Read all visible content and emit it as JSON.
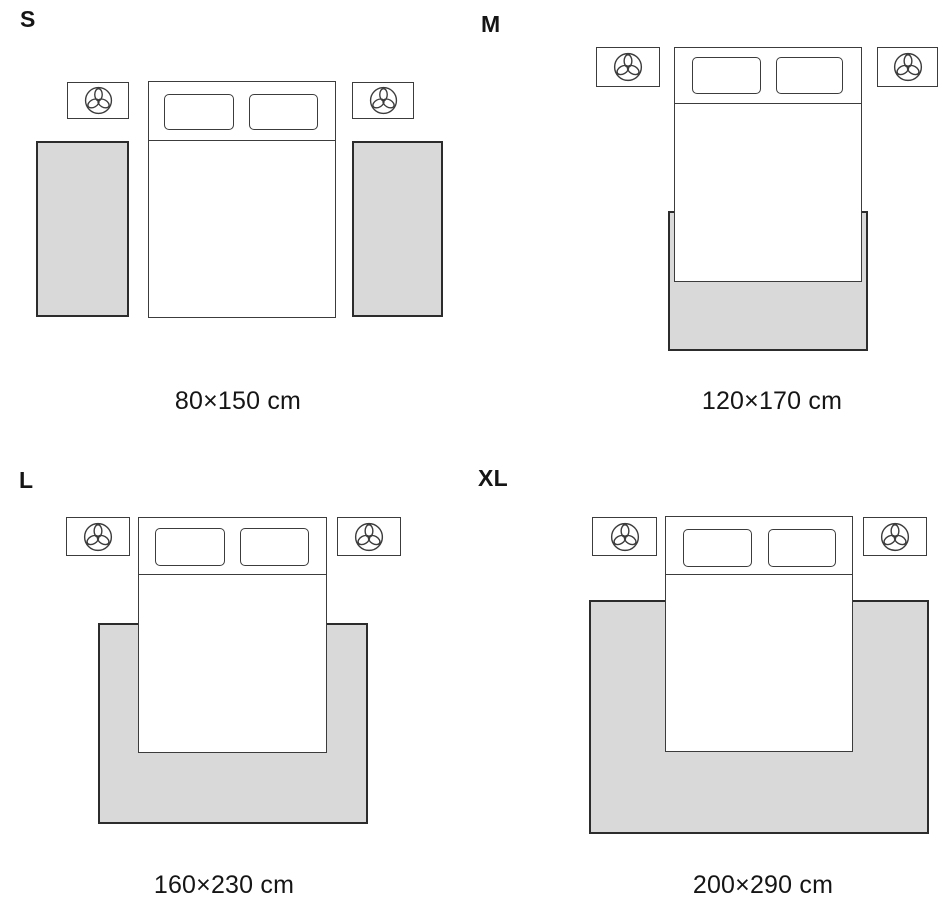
{
  "title": "Rug size guide for bedroom",
  "colors": {
    "background": "#ffffff",
    "outline": "#3c3c3c",
    "rug_fill": "#d9d9d9",
    "rug_border": "#2c2c2c",
    "text": "#151515"
  },
  "icon_names": {
    "nightstand_icon": "plant-icon"
  },
  "panels": [
    {
      "label": "S",
      "size_label": "80×150 cm",
      "rug_placement": "two runner rugs, one on each side of the bed"
    },
    {
      "label": "M",
      "size_label": "120×170 cm",
      "rug_placement": "rug under the foot of the bed"
    },
    {
      "label": "L",
      "size_label": "160×230 cm",
      "rug_placement": "rug under the lower two-thirds of the bed"
    },
    {
      "label": "XL",
      "size_label": "200×290 cm",
      "rug_placement": "large rug extending well beyond the bed"
    }
  ]
}
